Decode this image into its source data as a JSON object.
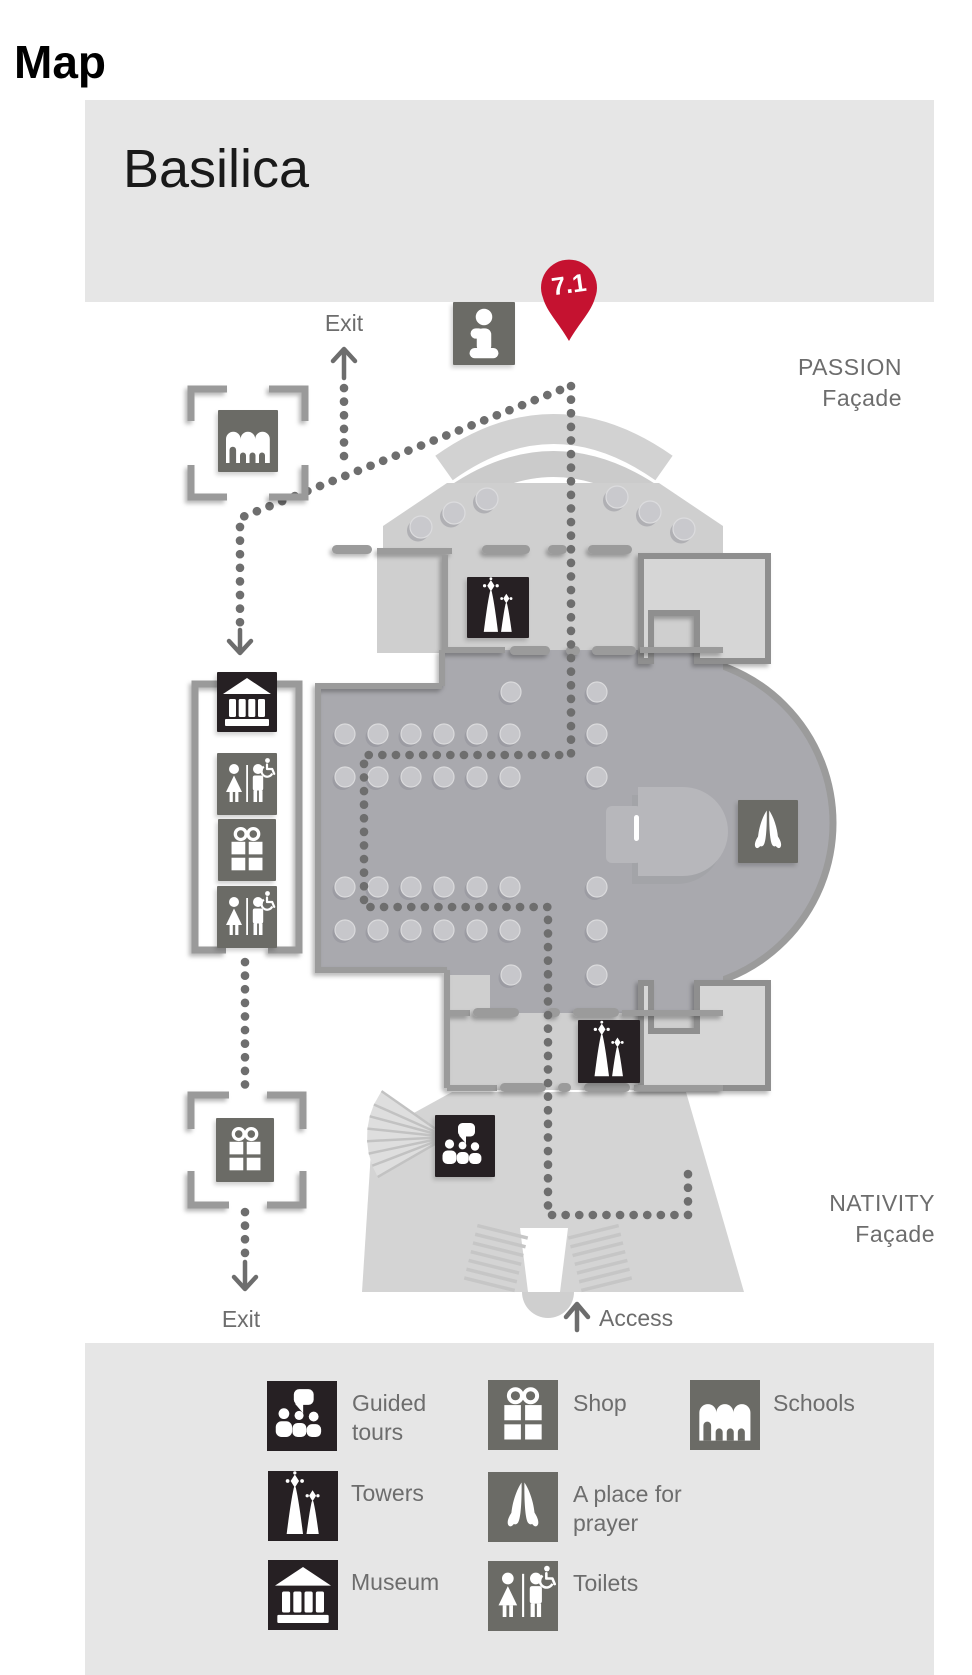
{
  "page": {
    "title": "Map"
  },
  "map": {
    "title": "Basilica",
    "pin": {
      "label": "7.1",
      "color": "#c51230"
    },
    "labels": {
      "passion_line1": "PASSION",
      "passion_line2": "Façade",
      "nativity_line1": "NATIVITY",
      "nativity_line2": "Façade",
      "exit_top": "Exit",
      "exit_bottom": "Exit",
      "access": "Access"
    },
    "markers": [
      "info-icon",
      "schools-icon",
      "museum-icon",
      "toilets-icon",
      "shop-icon",
      "toilets-icon",
      "shop-icon",
      "towers-icon",
      "prayer-icon",
      "towers-icon",
      "guided-tours-icon"
    ]
  },
  "legend": {
    "items": [
      {
        "id": "guided-tours",
        "label": "Guided tours",
        "icon": "guided-tours-icon",
        "style": "dark"
      },
      {
        "id": "shop",
        "label": "Shop",
        "icon": "shop-icon",
        "style": "gray"
      },
      {
        "id": "schools",
        "label": "Schools",
        "icon": "schools-icon",
        "style": "gray"
      },
      {
        "id": "towers",
        "label": "Towers",
        "icon": "towers-icon",
        "style": "dark"
      },
      {
        "id": "prayer",
        "label": "A place for prayer",
        "icon": "prayer-icon",
        "style": "gray"
      },
      {
        "id": "museum",
        "label": "Museum",
        "icon": "museum-icon",
        "style": "dark"
      },
      {
        "id": "toilets",
        "label": "Toilets",
        "icon": "toilets-icon",
        "style": "gray"
      }
    ]
  },
  "colors": {
    "pin": "#c51230",
    "icon_dark": "#262023",
    "icon_gray": "#6b6b66",
    "text_gray": "#6d6d6d",
    "band": "#e6e6e6",
    "nave": "#a9a9ae",
    "light": "#cfcfcf",
    "wall": "#9b9b9b",
    "dots": "#6e6e6e"
  }
}
